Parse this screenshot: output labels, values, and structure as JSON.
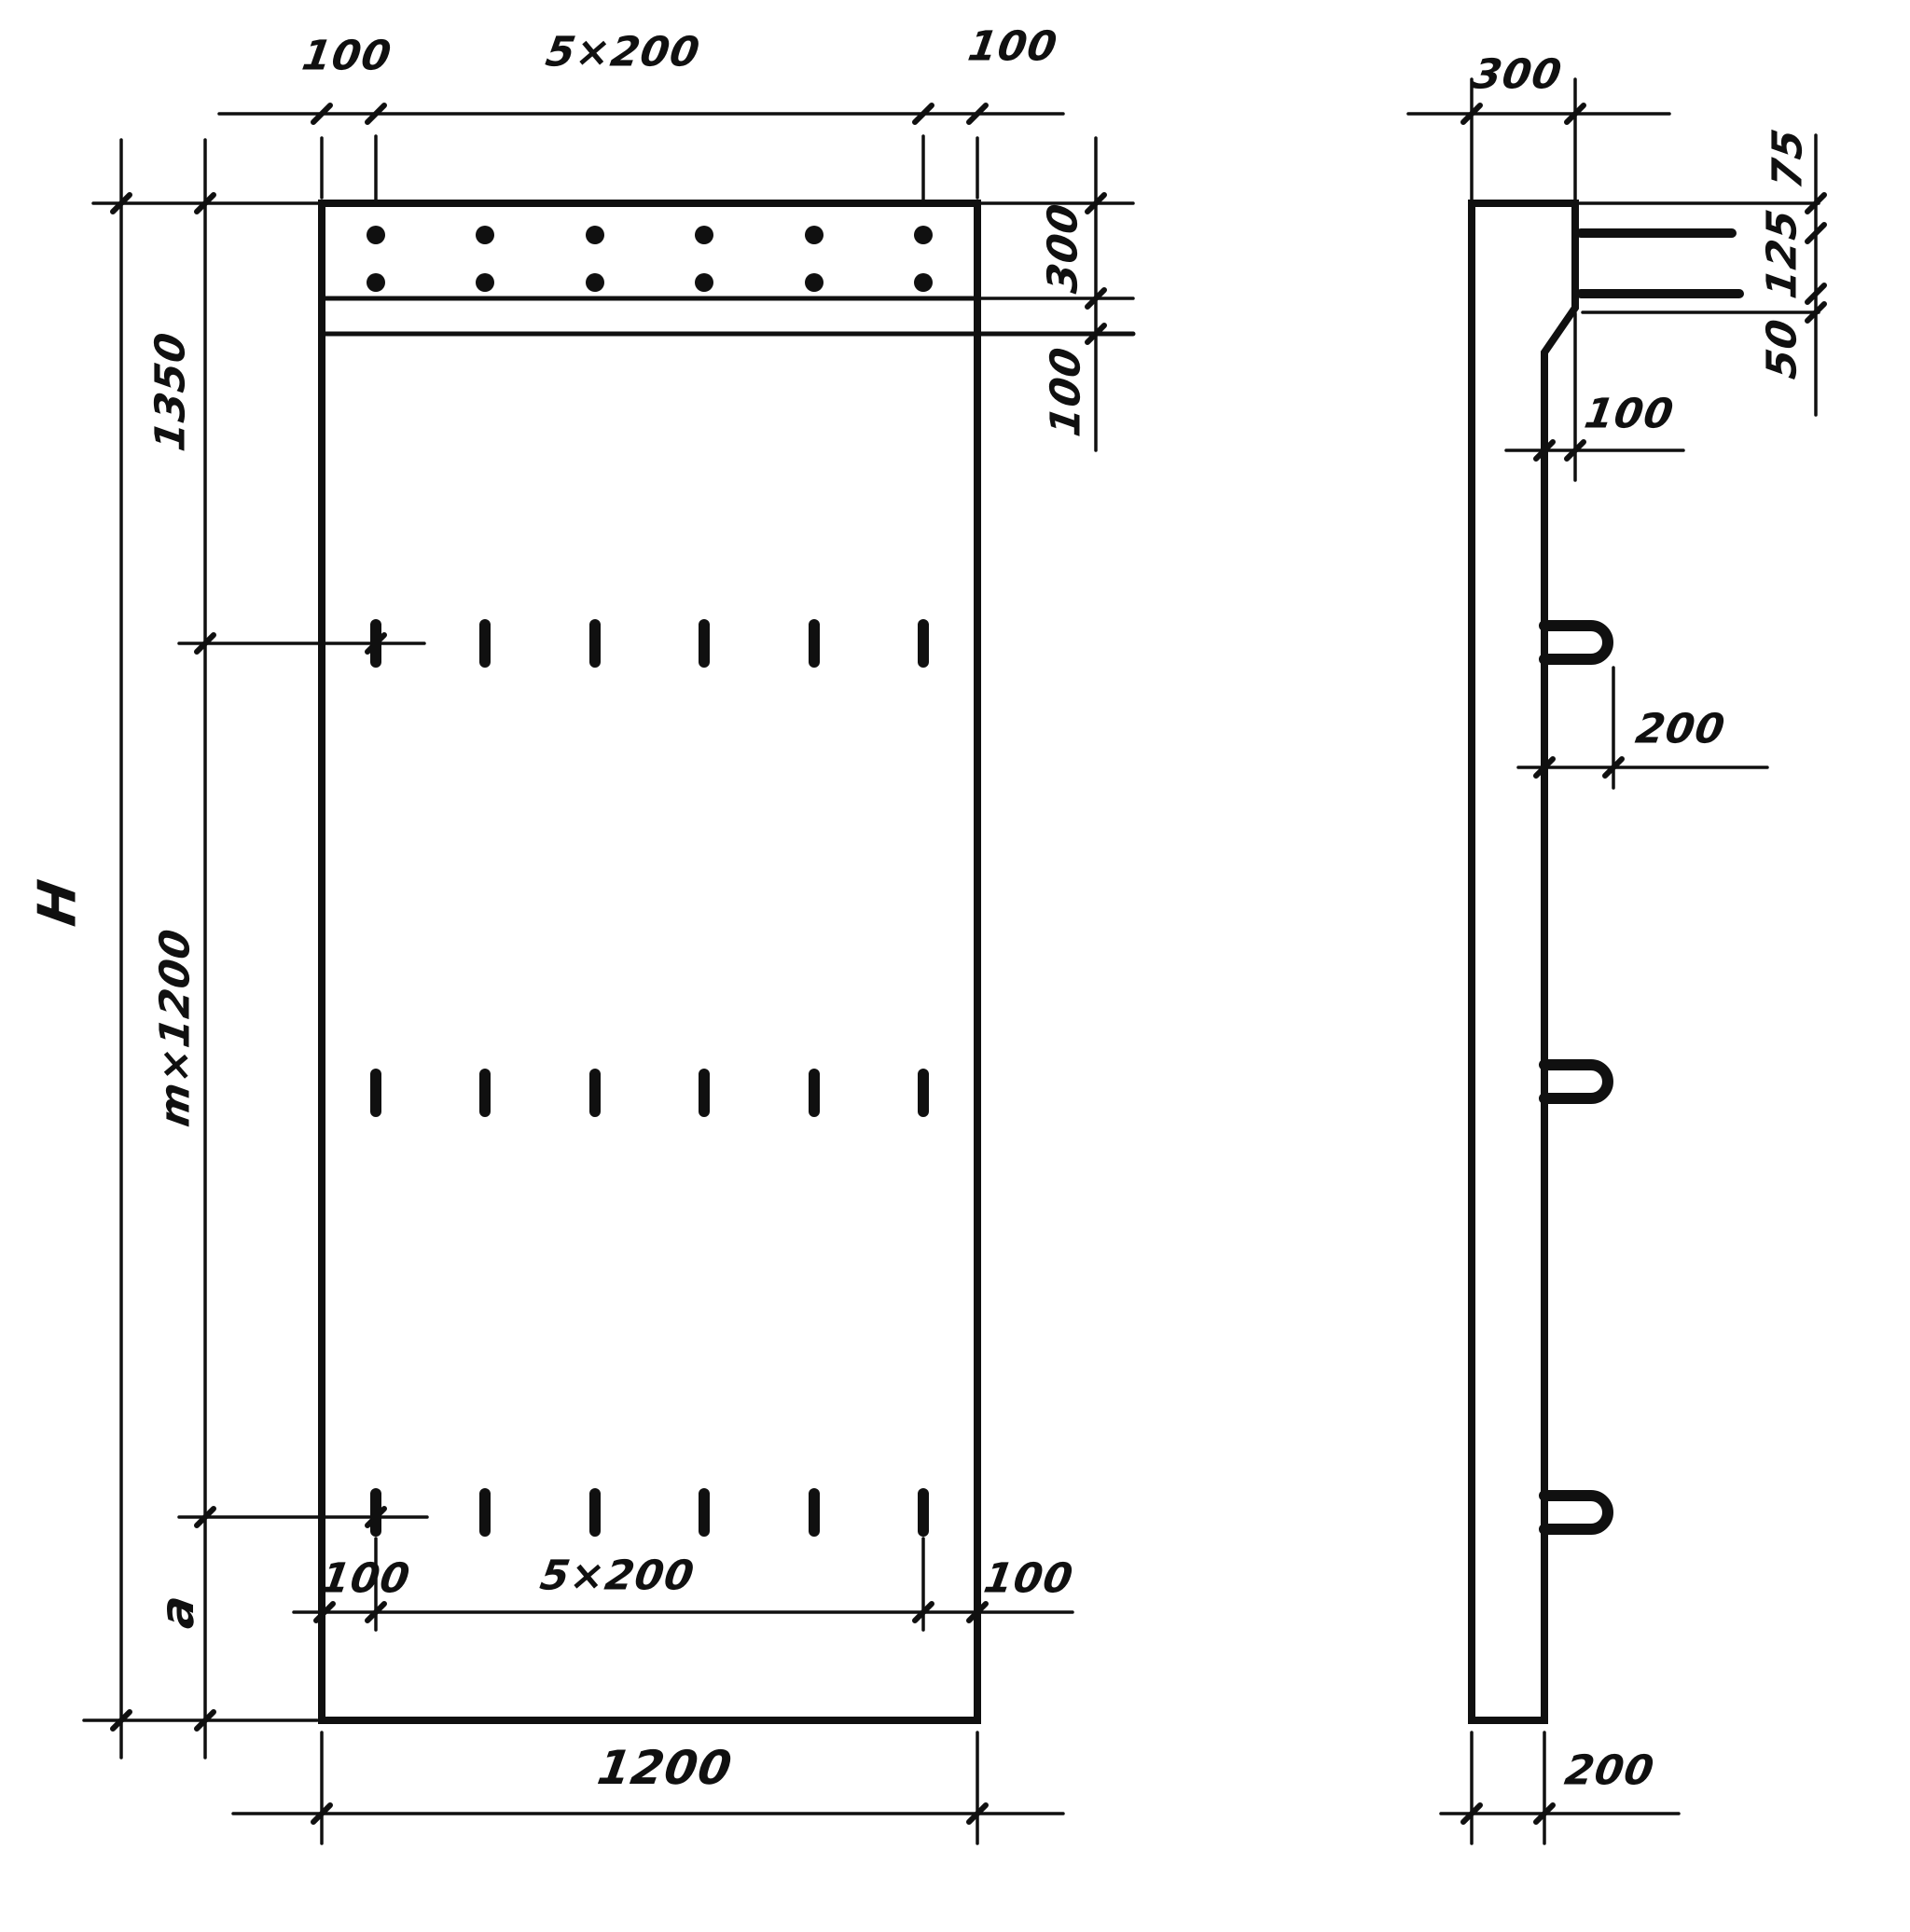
{
  "drawing_type": "engineering-dimension-drawing",
  "colors": {
    "ink": "#101010",
    "paper": "#ffffff"
  },
  "front": {
    "top": {
      "left": "100",
      "mid": "5×200",
      "right": "100"
    },
    "right_band": {
      "height": "300",
      "gap": "100"
    },
    "left": {
      "first": "1350",
      "middle": "m×1200",
      "last": "a",
      "overall": "H"
    },
    "bottom_inner": {
      "left": "100",
      "mid": "5×200",
      "right": "100"
    },
    "bottom": {
      "overall": "1200"
    }
  },
  "side": {
    "top_thickness": "300",
    "chain": {
      "top": "75",
      "mid": "125",
      "bottom": "50"
    },
    "console_offset": "100",
    "loop_length": "200",
    "thickness": "200"
  }
}
